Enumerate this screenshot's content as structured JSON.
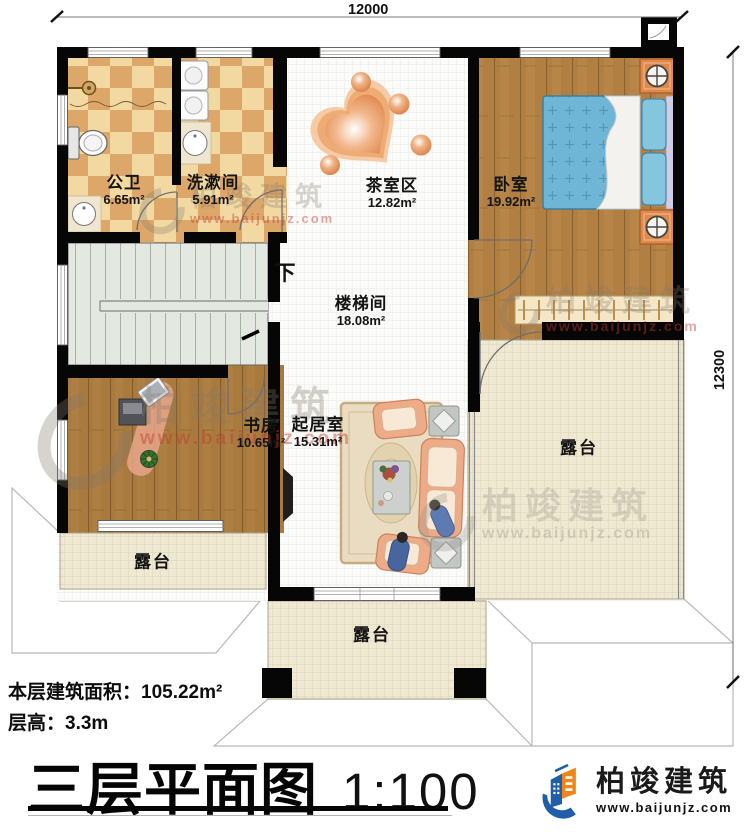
{
  "dimensions": {
    "top": "12000",
    "right": "12300"
  },
  "rooms": {
    "gongwei": {
      "name": "公卫",
      "area": "6.65m²"
    },
    "xishujian": {
      "name": "洗漱间",
      "area": "5.91m²"
    },
    "chashiqu": {
      "name": "茶室区",
      "area": "12.82m²"
    },
    "woshi": {
      "name": "卧室",
      "area": "19.92m²"
    },
    "loutijian": {
      "name": "楼梯间",
      "area": "18.08m²"
    },
    "shufang": {
      "name": "书房",
      "area": "10.65m²"
    },
    "qijushi": {
      "name": "起居室",
      "area": "15.31m²"
    }
  },
  "terrace_label": "露台",
  "stairs": {
    "direction_label": "下"
  },
  "notes": {
    "floor_area": "本层建筑面积：105.22m²",
    "floor_height": "层高：3.3m"
  },
  "title": {
    "main": "三层平面图",
    "scale": "1:100"
  },
  "logo": {
    "brand": "柏竣建筑",
    "url": "www.baijunjz.com"
  },
  "watermark": {
    "brand": "柏竣建筑",
    "url": "www.baijunjz.com"
  },
  "colors": {
    "wall": "#060606",
    "tile_light": "#f2d9a2",
    "tile_dark": "#dca768",
    "wood": "#b17f41",
    "bed_blue": "#6fb6d6",
    "terrace": "#efe9d3",
    "stair": "#e3e8e0",
    "nightstand": "#e0894d",
    "sofa": "#edab88",
    "logo_blue": "#1f5fa8",
    "logo_orange": "#f08519",
    "watermark_red": "#c0392b"
  }
}
